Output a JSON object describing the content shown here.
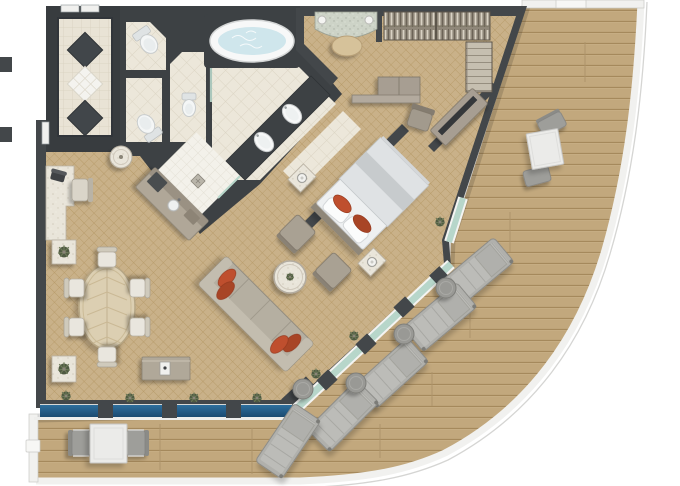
{
  "app": {
    "name": "suite-floor-plan",
    "description": "Top-down 3D-rendered floor plan of a penthouse ship suite with wrap-around curved teak veranda"
  },
  "colors": {
    "wall": "#43474a",
    "wallDark": "#383c3f",
    "carpet": "#c9b189",
    "carpetLine": "#b2945f",
    "deckWood": "#c2a87d",
    "deckLine": "#a5895c",
    "railing": "#f1f1ef",
    "tile": "#ece7da",
    "tileLine": "#dbd4c3",
    "showerTile": "#f3f1ea",
    "glassBlue": "#2e6f9e",
    "glassBlueDark": "#1b4a70",
    "glassTeal": "#b7d6ca",
    "accentRed": "#bf4f2e",
    "accentRedDark": "#a84426",
    "sofaBeige": "#b5afa1",
    "furnitureGray": "#a79e92",
    "loungerGray": "#b0b0ac",
    "deckTableWhite": "#ebebe9",
    "marble": "#e9e5da",
    "granite": "#cdd3c7",
    "water": "#cfe6ec",
    "bedWhite": "#eef0f1",
    "diningTable": "#dccfb2",
    "stoolTan": "#d6c29a",
    "plantGreen": "#4f5a42"
  },
  "interior": {
    "entry": {
      "name": "entry foyer",
      "features": [
        "double entry door",
        "marble floor",
        "diamond inlay x3",
        "corridor door"
      ]
    },
    "bathroom": {
      "fixtures": [
        "oval whirlpool tub",
        "double sink vanity",
        "shower with drain",
        "toilet",
        "toilet",
        "bidet",
        "glass partition"
      ]
    },
    "bedroom": {
      "furniture": [
        "king bed with red accent pillows",
        "nightstand with lamp",
        "nightstand with lamp",
        "armchair",
        "armchair",
        "tv cabinet",
        "dresser with shelf",
        "desk chair",
        "walk-in closet hanging rails",
        "closet shelves",
        "dressing table",
        "vanity stool"
      ],
      "armchair_count": 2,
      "nightstand_count": 2
    },
    "living": {
      "furniture": [
        "oval dining table",
        "dining chairs",
        "sofa with red cushions",
        "round marble coffee table",
        "round side table",
        "writing desk with telephone",
        "desk chair",
        "wet bar with sink",
        "sideboard with espresso machine",
        "marble pedestal with plant",
        "marble pedestal with plant"
      ],
      "dining_chair_count": 6,
      "sofa_cushion_count": 4
    },
    "windows": {
      "bottom_band": "blue glazed window wall with 3 mullions and sill plants",
      "diagonal_band": "teal sliding glass doors to veranda",
      "bedroom_door": "teal glass door to veranda"
    }
  },
  "veranda": {
    "deck": "teak planks",
    "railing": "white curved railing",
    "furniture": [
      "square dining table",
      "deck chair",
      "deck chair",
      "cafe table",
      "cafe chair",
      "cafe chair",
      "sun lounger",
      "round side table"
    ],
    "sun_lounger_count": 5,
    "side_table_count": 4,
    "bistro_set_count": 2
  }
}
